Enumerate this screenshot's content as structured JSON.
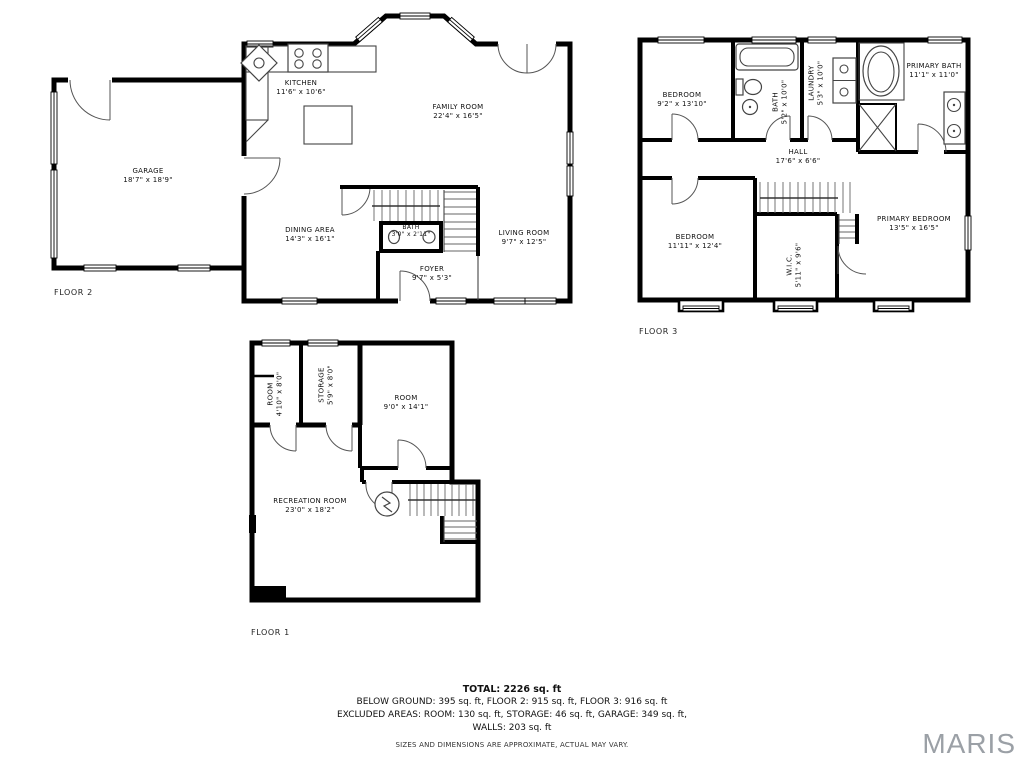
{
  "floors": {
    "floor2": {
      "label": "FLOOR 2",
      "rooms": {
        "kitchen": {
          "name": "KITCHEN",
          "dims": "11'6\" x 10'6\""
        },
        "family_room": {
          "name": "FAMILY ROOM",
          "dims": "22'4\" x 16'5\""
        },
        "garage": {
          "name": "GARAGE",
          "dims": "18'7\" x 18'9\""
        },
        "dining_area": {
          "name": "DINING AREA",
          "dims": "14'3\" x 16'1\""
        },
        "bath": {
          "name": "BATH",
          "dims": "3'0\" x 2'11\""
        },
        "living_room": {
          "name": "LIVING ROOM",
          "dims": "9'7\" x 12'5\""
        },
        "foyer": {
          "name": "FOYER",
          "dims": "9'7\" x 5'3\""
        }
      }
    },
    "floor3": {
      "label": "FLOOR 3",
      "rooms": {
        "bedroom1": {
          "name": "BEDROOM",
          "dims": "9'2\" x 13'10\""
        },
        "bath": {
          "name": "BATH",
          "dims": "5'2\" x 10'0\""
        },
        "laundry": {
          "name": "LAUNDRY",
          "dims": "5'3\" x 10'0\""
        },
        "primary_bath": {
          "name": "PRIMARY BATH",
          "dims": "11'1\" x 11'0\""
        },
        "hall": {
          "name": "HALL",
          "dims": "17'6\" x 6'6\""
        },
        "bedroom2": {
          "name": "BEDROOM",
          "dims": "11'11\" x 12'4\""
        },
        "wic": {
          "name": "W.I.C.",
          "dims": "5'11\" x 9'6\""
        },
        "primary_bedroom": {
          "name": "PRIMARY BEDROOM",
          "dims": "13'5\" x 16'5\""
        }
      }
    },
    "floor1": {
      "label": "FLOOR 1",
      "rooms": {
        "room_small": {
          "name": "ROOM",
          "dims": "4'10\" x 8'0\""
        },
        "storage": {
          "name": "STORAGE",
          "dims": "5'9\" x 8'0\""
        },
        "room": {
          "name": "ROOM",
          "dims": "9'0\" x 14'1\""
        },
        "recreation_room": {
          "name": "RECREATION ROOM",
          "dims": "23'0\" x 18'2\""
        }
      }
    }
  },
  "summary": {
    "total": "TOTAL: 2226 sq. ft",
    "below_line": "BELOW GROUND: 395 sq. ft, FLOOR 2: 915 sq. ft, FLOOR 3: 916 sq. ft",
    "excluded_line": "EXCLUDED AREAS: ROOM: 130 sq. ft, STORAGE: 46 sq. ft, GARAGE: 349 sq. ft,",
    "walls_line": "WALLS: 203 sq. ft",
    "disclaimer": "SIZES AND DIMENSIONS ARE APPROXIMATE, ACTUAL MAY VARY."
  },
  "brand": {
    "name": "MARIS",
    "color": "#9ba0a6"
  },
  "colors": {
    "walls": "#000000",
    "background": "#ffffff"
  }
}
